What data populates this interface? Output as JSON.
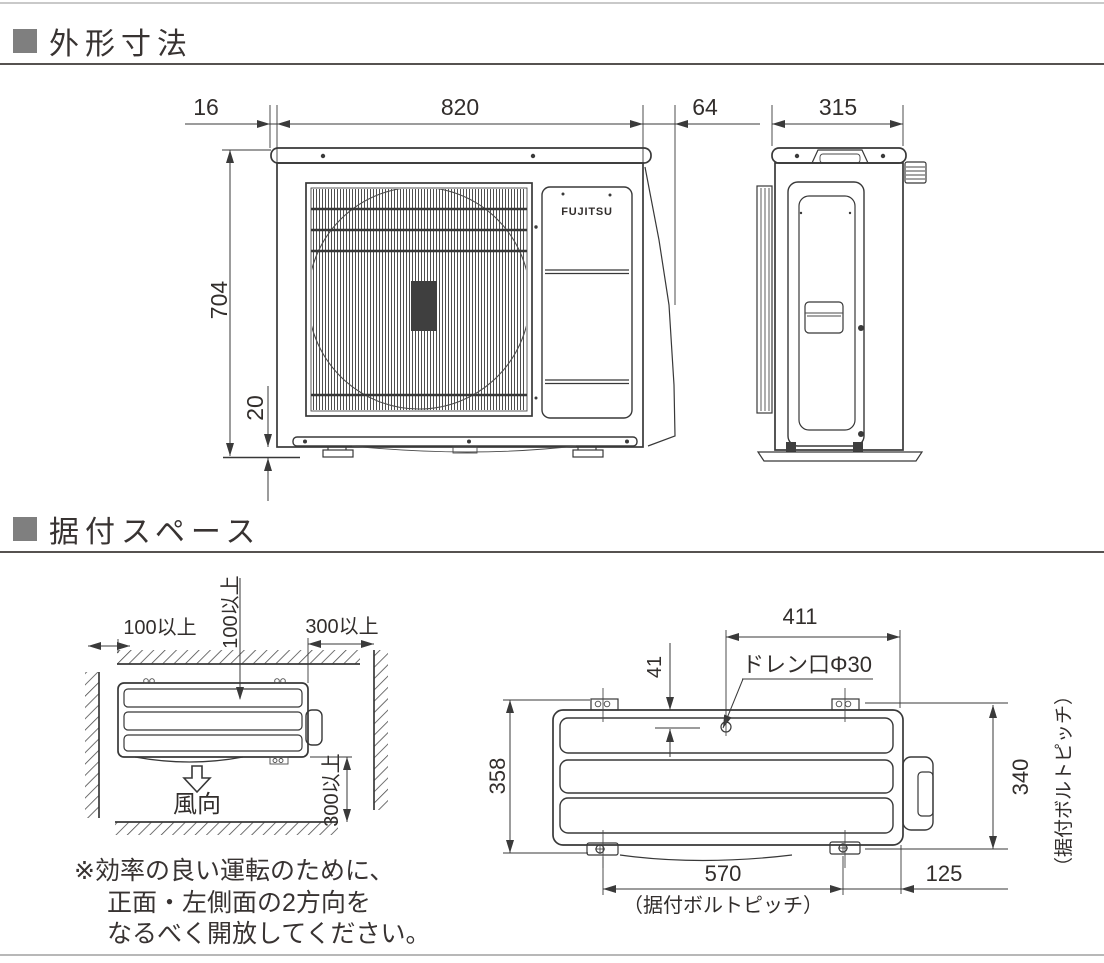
{
  "colors": {
    "header_square": "#7f7f7f",
    "line": "#3a3a3a"
  },
  "sections": {
    "dimensions": {
      "title": "外形寸法"
    },
    "installation": {
      "title": "据付スペース"
    }
  },
  "front_view": {
    "logo": "FUJITSU",
    "dim_top_overhang": "16",
    "dim_width": "820",
    "dim_side_protrusion": "64",
    "dim_height": "704",
    "dim_base_height": "20"
  },
  "side_view": {
    "dim_depth": "315"
  },
  "install_left": {
    "dim_left_clearance": "100以上",
    "dim_back_clearance": "100以上",
    "dim_right_clearance": "300以上",
    "dim_front_clearance": "300以上",
    "airflow_label": "風向"
  },
  "install_bottom": {
    "dim_drain_x": "411",
    "dim_drain_y": "41",
    "drain_label": "ドレン口Φ30",
    "dim_depth": "358",
    "dim_bolt_pitch_v": "340",
    "bolt_pitch_v_label": "（据付ボルトピッチ）",
    "dim_bolt_pitch_h": "570",
    "bolt_pitch_h_label": "（据付ボルトピッチ）",
    "dim_right_offset": "125"
  },
  "note": {
    "line1": "※効率の良い運転のために、",
    "line2": "正面・左側面の2方向を",
    "line3": "なるべく開放してください。"
  }
}
